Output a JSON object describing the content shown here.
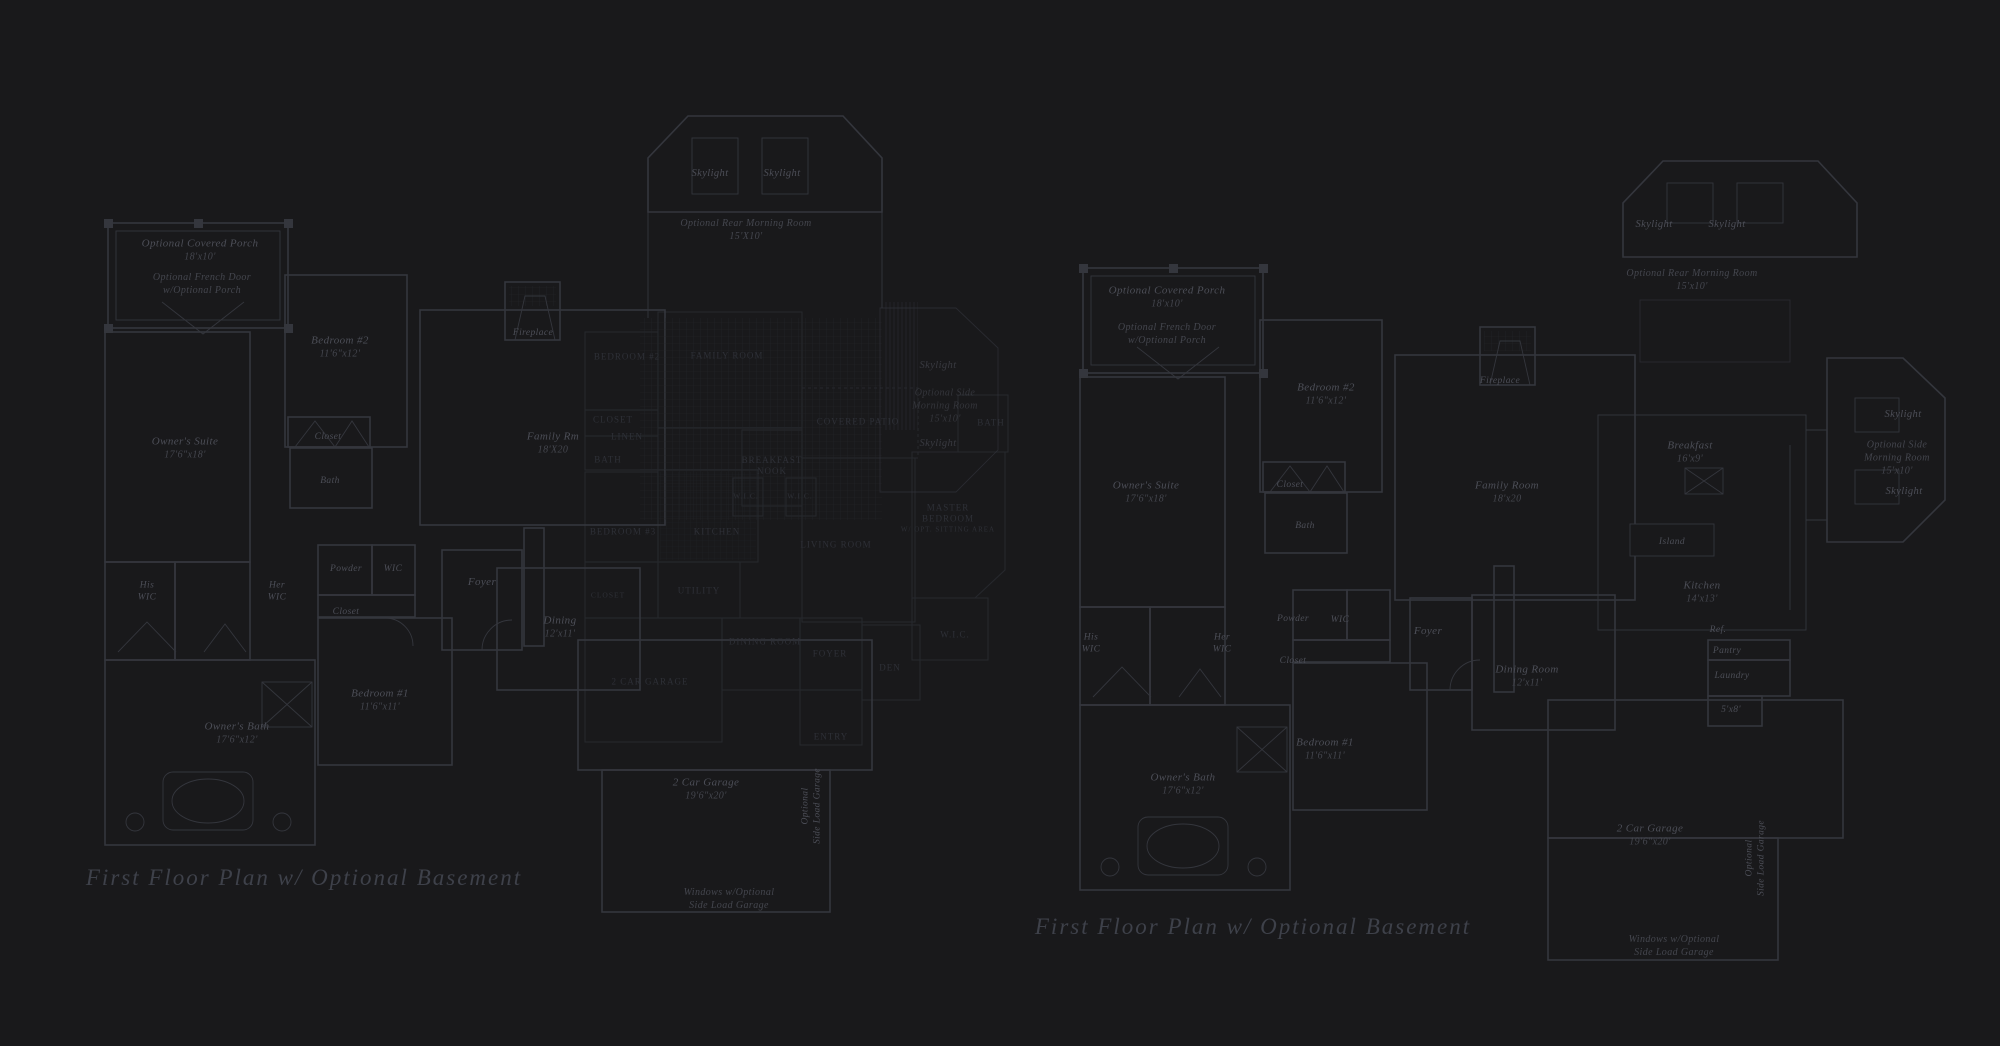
{
  "colors": {
    "background": "#19191b",
    "plan_line": "#34363d",
    "dim_plan_line": "#26282d",
    "label": "#4c4e57",
    "dim_label": "#2e3037",
    "title": "#3e414a"
  },
  "left_plan": {
    "title": "First Floor Plan  w/ Optional Basement",
    "covered_porch": "Optional Covered Porch",
    "covered_porch_dims": "18'x10'",
    "french_door_line1": "Optional French Door",
    "french_door_line2": "w/Optional Porch",
    "owners_suite": "Owner's Suite",
    "owners_suite_dims": "17'6\"x18'",
    "bedroom2": "Bedroom #2",
    "bedroom2_dims": "11'6\"x12'",
    "bedroom2_closet": "Closet",
    "bedroom2_bath": "Bath",
    "fireplace": "Fireplace",
    "family_room": "Family Rm",
    "family_room_dims": "18'X20",
    "skylight_left": "Skylight",
    "skylight_right": "Skylight",
    "rear_morning_room": "Optional Rear Morning Room",
    "rear_morning_room_dims": "15'X10'",
    "side_skylight_top": "Skylight",
    "side_morning_line1": "Optional Side",
    "side_morning_line2": "Morning Room",
    "side_morning_dims": "15'x10'",
    "side_skylight_bottom": "Skylight",
    "his_wic_line1": "His",
    "his_wic_line2": "WIC",
    "her_wic_line1": "Her",
    "her_wic_line2": "WIC",
    "powder": "Powder",
    "hall_wic": "WIC",
    "hall_closet": "Closet",
    "bedroom1": "Bedroom #1",
    "bedroom1_dims": "11'6\"x11'",
    "owners_bath": "Owner's Bath",
    "owners_bath_dims": "17'6\"x12'",
    "foyer": "Foyer",
    "dining": "Dining",
    "dining_dims": "12'x11'",
    "garage": "2 Car Garage",
    "garage_dims": "19'6\"x20'",
    "side_load_line1": "Optional",
    "side_load_line2": "Side Load Garage",
    "windows_line1": "Windows w/Optional",
    "windows_line2": "Side Load Garage"
  },
  "dim_plan": {
    "bedroom2": "BEDROOM #2",
    "family_room": "FAMILY ROOM",
    "closet": "CLOSET",
    "linen": "LINEN",
    "bath": "BATH",
    "bedroom3": "BEDROOM #3",
    "kitchen": "KITCHEN",
    "breakfast_line1": "BREAKFAST",
    "breakfast_line2": "NOOK",
    "covered_patio": "COVERED PATIO",
    "living_room": "LIVING ROOM",
    "master_line1": "MASTER",
    "master_line2": "BEDROOM",
    "master_line3": "W/ OPT. SITTING AREA",
    "wic_a": "W.I.C.",
    "wic_b": "W.I.C.",
    "wic_master": "W.I.C.",
    "bath_master": "BATH",
    "utility": "UTILITY",
    "closet2": "CLOSET",
    "dining_room": "DINING ROOM",
    "foyer": "FOYER",
    "den": "DEN",
    "entry": "ENTRY",
    "garage": "2 CAR GARAGE"
  },
  "right_plan": {
    "title": "First Floor Plan  w/ Optional Basement",
    "covered_porch": "Optional Covered Porch",
    "covered_porch_dims": "18'x10'",
    "french_door_line1": "Optional French Door",
    "french_door_line2": "w/Optional Porch",
    "owners_suite": "Owner's Suite",
    "owners_suite_dims": "17'6\"x18'",
    "bedroom2": "Bedroom #2",
    "bedroom2_dims": "11'6\"x12'",
    "bedroom2_closet": "Closet",
    "bedroom2_bath": "Bath",
    "fireplace": "Fireplace",
    "family_room": "Family Room",
    "family_room_dims": "18'x20",
    "skylight_left": "Skylight",
    "skylight_right": "Skylight",
    "rear_morning_room": "Optional Rear Morning Room",
    "rear_morning_room_dims": "15'x10'",
    "side_skylight_top": "Skylight",
    "side_morning_line1": "Optional Side",
    "side_morning_line2": "Morning Room",
    "side_morning_dims": "15'x10'",
    "side_skylight_bottom": "Skylight",
    "breakfast": "Breakfast",
    "breakfast_dims": "16'x9'",
    "island": "Island",
    "kitchen": "Kitchen",
    "kitchen_dims": "14'x13'",
    "ref": "Ref.",
    "pantry": "Pantry",
    "laundry": "Laundry",
    "porch_dims": "5'x8'",
    "his_wic_line1": "His",
    "his_wic_line2": "WIC",
    "her_wic_line1": "Her",
    "her_wic_line2": "WIC",
    "powder": "Powder",
    "hall_wic": "WIC",
    "hall_closet": "Closet",
    "bedroom1": "Bedroom #1",
    "bedroom1_dims": "11'6\"x11'",
    "owners_bath": "Owner's Bath",
    "owners_bath_dims": "17'6\"x12'",
    "foyer": "Foyer",
    "dining_room": "Dining Room",
    "dining_room_dims": "12'x11'",
    "garage": "2 Car Garage",
    "garage_dims": "19'6\"x20'",
    "side_load_line1": "Optional",
    "side_load_line2": "Side Load Garage",
    "windows_line1": "Windows w/Optional",
    "windows_line2": "Side Load Garage"
  }
}
